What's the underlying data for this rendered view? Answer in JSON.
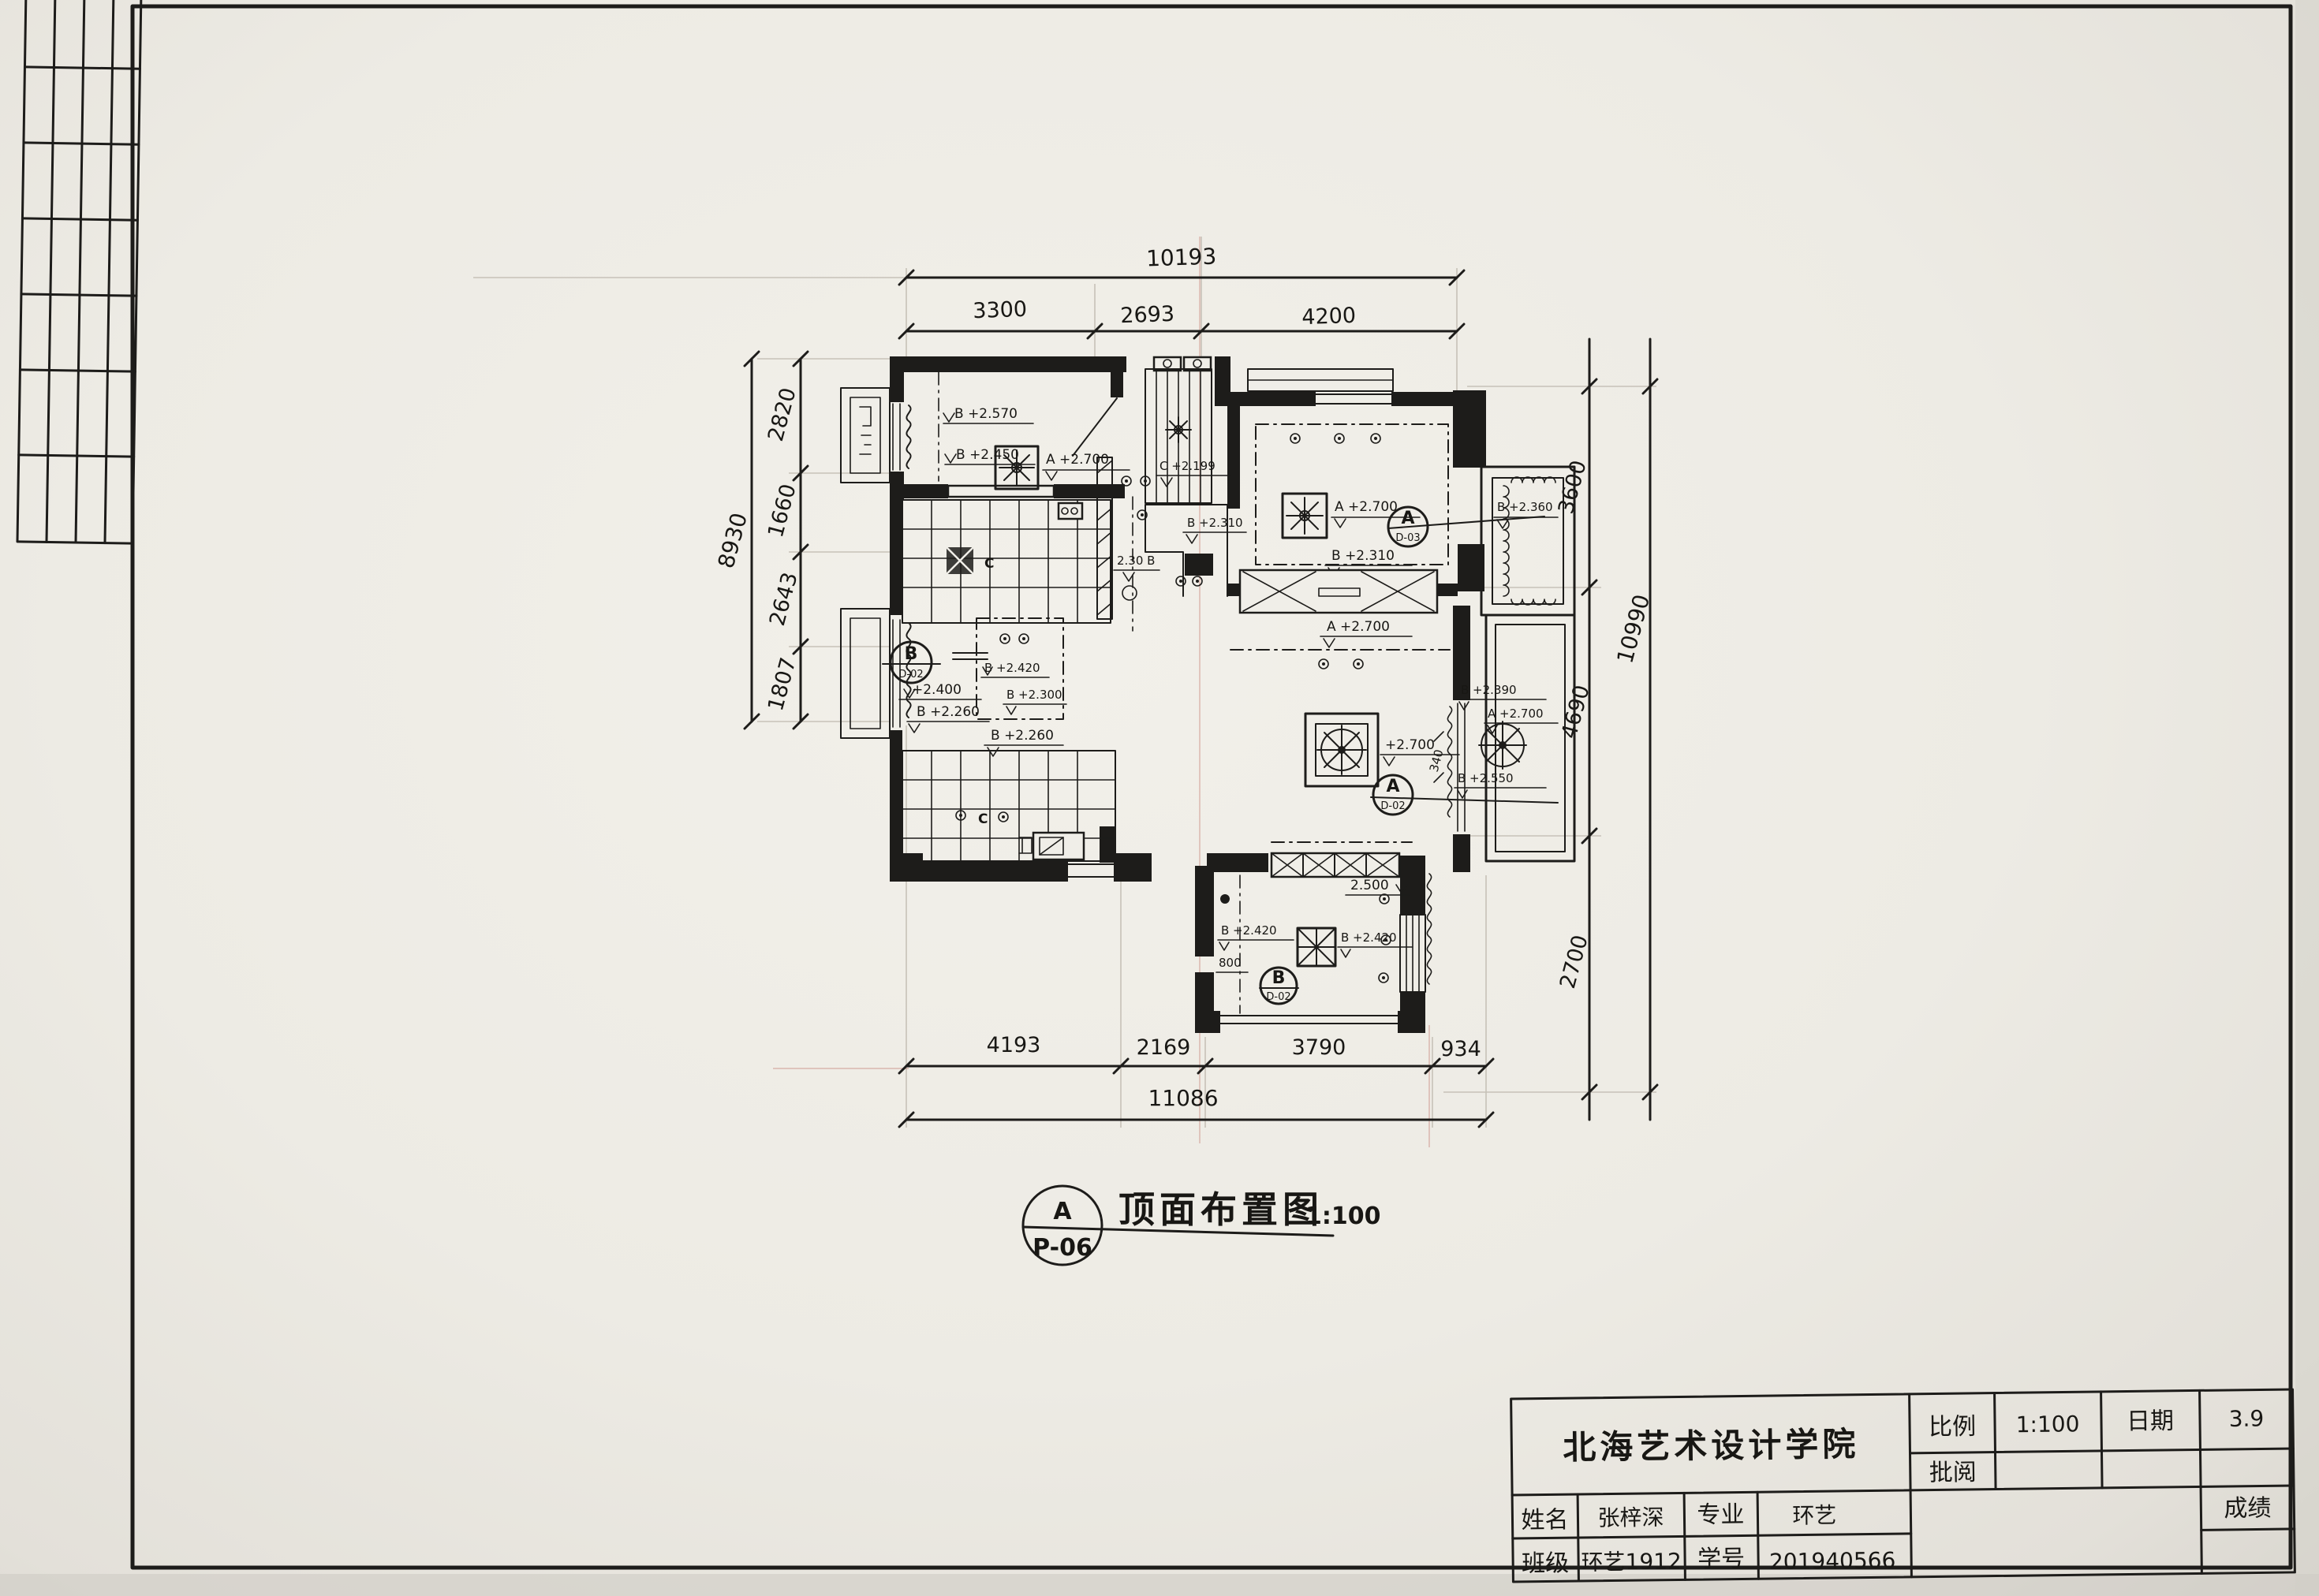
{
  "sheet": {
    "tag_letter": "A",
    "tag_code": "P-06",
    "title": "顶面布置图",
    "scale": "1:100"
  },
  "dims": {
    "top_overall": "10193",
    "top_segments": [
      "3300",
      "2693",
      "4200"
    ],
    "left_overall": "8930",
    "left_segments": [
      "2820",
      "1660",
      "2643",
      "1807"
    ],
    "right_overall": "10990",
    "right_segments": [
      "3600",
      "4690",
      "2700"
    ],
    "bottom_overall": "11086",
    "bottom_segments": [
      "4193",
      "2169",
      "3790",
      "934"
    ]
  },
  "tags": [
    {
      "letter": "A",
      "code": "D-03"
    },
    {
      "letter": "B",
      "code": "D-02"
    },
    {
      "letter": "A",
      "code": "D-02"
    },
    {
      "letter": "B",
      "code": "D-02"
    }
  ],
  "labels": {
    "roomA_fan": "A +2.700",
    "roomA_l1": "B +2.570",
    "roomA_l2": "B +2.450",
    "bath_c": "C",
    "hall_c": "C +2.199",
    "hall_b1": "B +2.310",
    "hall_b2": "2.30 B",
    "master_fan": "A +2.700",
    "master_bay": "B +2.360",
    "master_bottom": "B +2.310",
    "living_top": "A +2.700",
    "living_fan": "+2.700",
    "living_r1": "B +2.390",
    "living_r2": "B +2.550",
    "living_340": "340",
    "beam_2500": "2.500",
    "balcony_fan": "A +2.700",
    "dining_l1": "+2.400",
    "dining_l2": "B +2.260",
    "dining_c1": "B +2.420",
    "dining_c2": "B +2.300",
    "dining_c3": "B +2.260",
    "kitchen_c": "C",
    "bottom_l1": "B +2.420",
    "bottom_fan": "B +2.420",
    "bottom_800": "800"
  },
  "title_block": {
    "school": "北海艺术设计学院",
    "scale_label": "比例",
    "scale_value": "1:100",
    "date_label": "日期",
    "date_value": "3.9",
    "review_label": "批阅",
    "review_value": "",
    "name_label": "姓名",
    "name_value": "张梓深",
    "major_label": "专业",
    "major_value": "环艺",
    "class_label": "班级",
    "class_value": "环艺1912",
    "id_label": "学号",
    "id_value": "201940566",
    "grade_label": "成绩",
    "grade_value": ""
  }
}
